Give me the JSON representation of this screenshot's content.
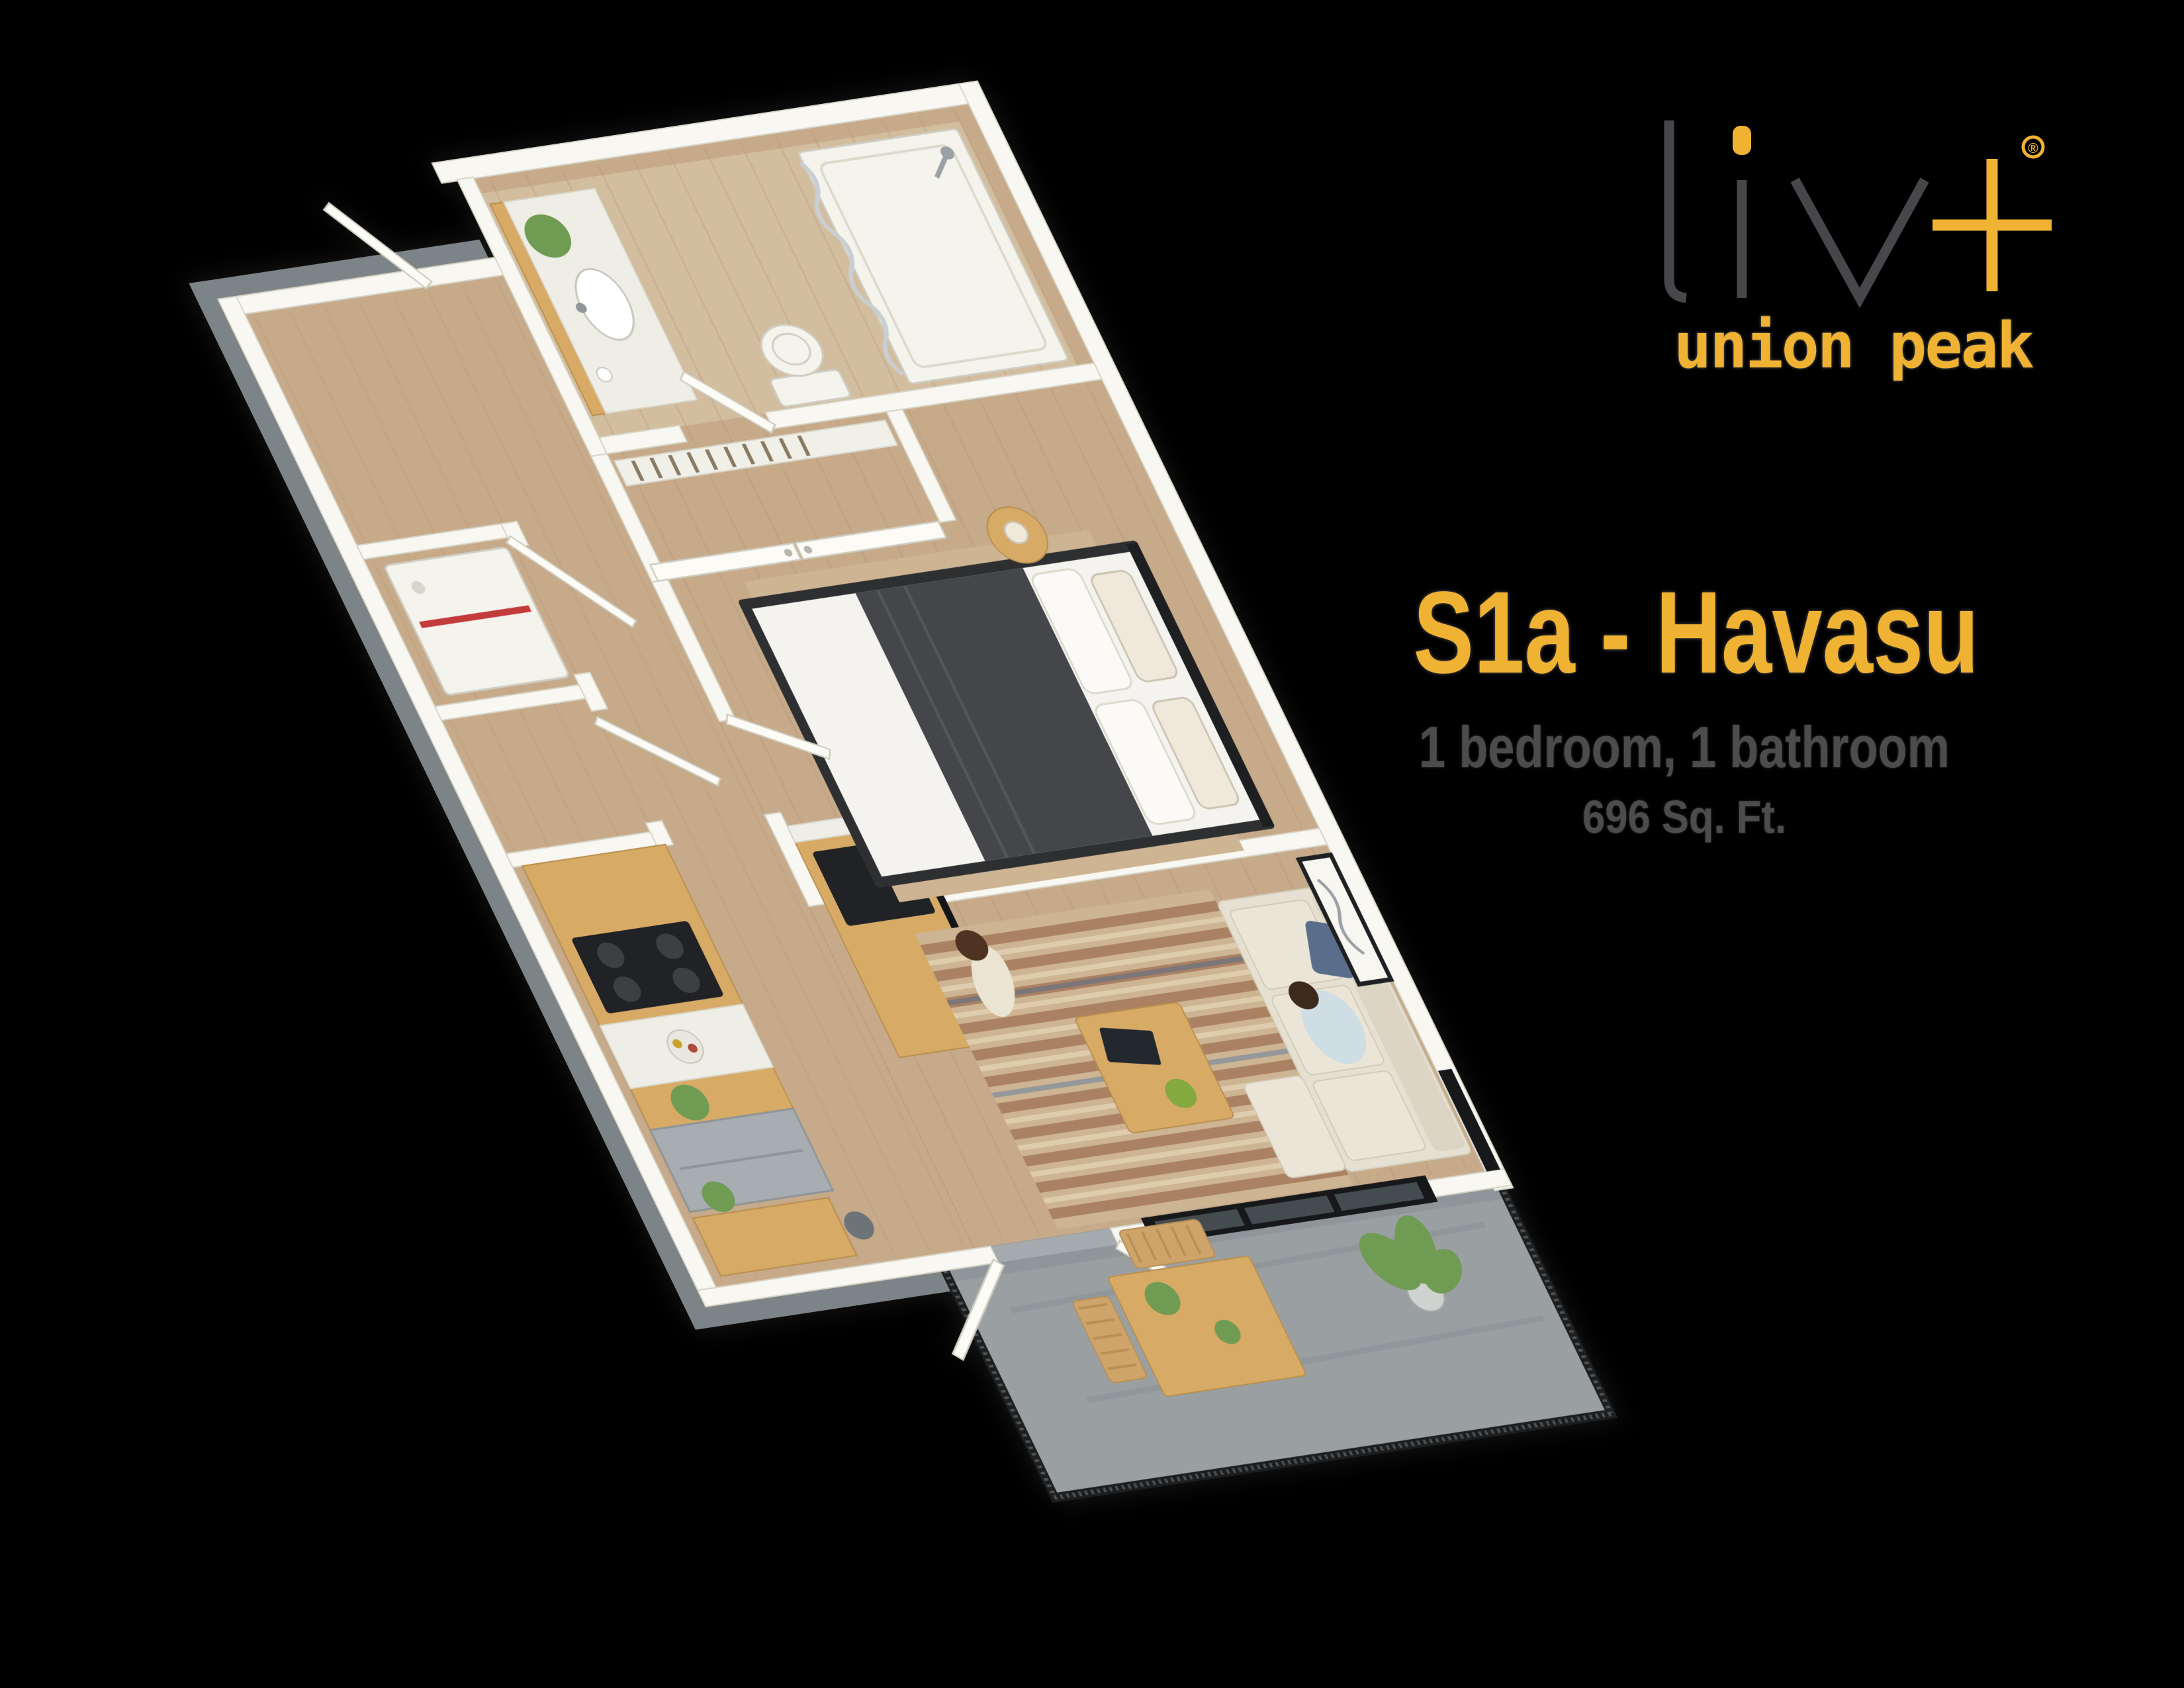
{
  "brand": {
    "logo_word": "liv",
    "registered": "®",
    "community": "union peak"
  },
  "plan": {
    "title": "S1a - Havasu",
    "bed_bath": "1 bedroom, 1 bathroom",
    "area": "696 Sq. Ft."
  },
  "colors": {
    "background": "#000000",
    "brand_yellow": "#f0b232",
    "logo_gray": "#46474b",
    "subtitle_gray": "#4b4c4e",
    "wall_white": "#f8f7f1",
    "floor_wood": "#c6aa8a",
    "balcony_concrete": "#9aa0a2",
    "exterior_gray": "#7d8487",
    "railing_black": "#1c1e20",
    "cabinet_wood": "#d7aa66",
    "counter_white": "#efeee6",
    "sofa_cream": "#e6e0d2",
    "bed_dark": "#44464a",
    "plant_green": "#6f9b53",
    "rug_tan": "#cdb493",
    "window_black": "#17181a"
  }
}
